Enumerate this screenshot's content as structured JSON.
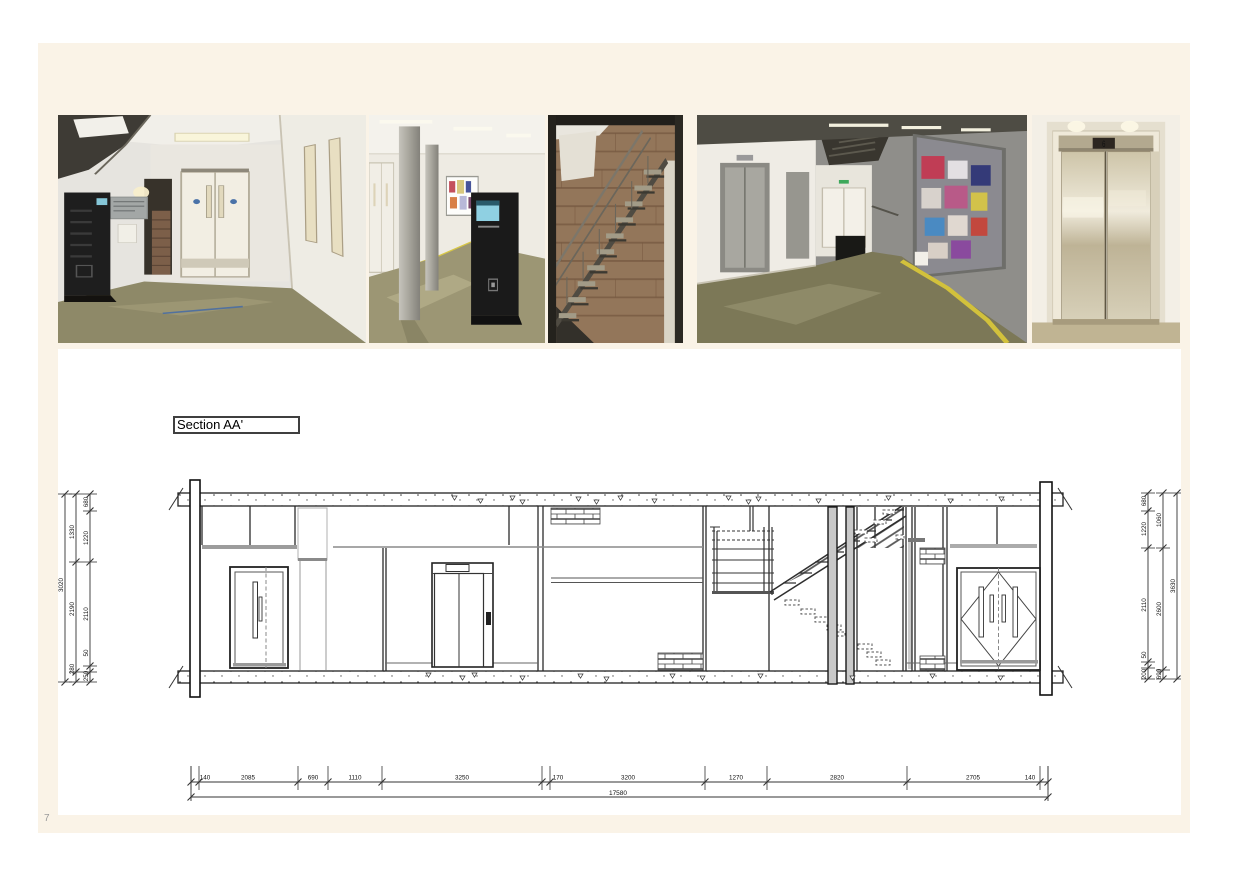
{
  "page": {
    "number": "7"
  },
  "section_label": "Section AA'",
  "photos": [
    {
      "description": "Corridor with double doors, wall directory and battery charging locker"
    },
    {
      "description": "Corridor with concrete columns, noticeboard and information kiosk"
    },
    {
      "description": "Open steel staircase against exposed brick wall"
    },
    {
      "description": "Corridor with lifts, noticeboard and staircase"
    },
    {
      "description": "Stainless steel lift doors with floor indicator",
      "indicator_digit": "6"
    }
  ],
  "drawing": {
    "dimensions": {
      "left_outer": "3020",
      "left_mid": [
        "1330",
        "2190",
        "280"
      ],
      "left_inner": [
        "680",
        "1220",
        "2110",
        "50",
        "250"
      ],
      "right_inner": [
        "680",
        "1220",
        "2110",
        "50",
        "200"
      ],
      "right_mid": [
        "1060",
        "2600",
        "690"
      ],
      "right_outer": "3630",
      "bottom_segments": [
        "140",
        "2085",
        "690",
        "1110",
        "3250",
        "170",
        "3200",
        "1270",
        "2820",
        "2705",
        "140"
      ],
      "bottom_total": "17580"
    }
  },
  "colors": {
    "sheet": "#faf3e7",
    "panel": "#ffffff",
    "line": "#2b2b2b",
    "poche": "#c9c9c9"
  }
}
